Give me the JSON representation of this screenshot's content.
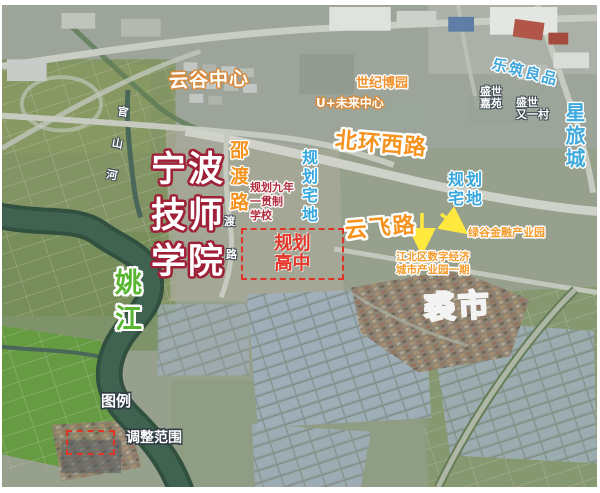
{
  "colors": {
    "road_label_orange": "#f6921e",
    "planning_blue": "#3aa7dd",
    "highlight_red": "#e5372b",
    "college_outline_red": "#9e2138",
    "river_label_green": "#59b630",
    "arrow_yellow": "#ffe93e"
  },
  "labels": {
    "yungu_center": "云谷中心",
    "shiji_boyuan": "世纪博园",
    "u_future_center": "U+未来中心",
    "lezhu_liangpin": "乐筑良品",
    "shengshi_jiayuan_line1": "盛世",
    "shengshi_jiayuan_line2": "嘉苑",
    "shengshi_youyicun_line1": "盛世",
    "shengshi_youyicun_line2": "又一村",
    "xinglvcheng": "星旅城",
    "beihuan_xilu": "北环西路",
    "shaodu_lu": "邵渡路",
    "planned_school_line1": "规划九年",
    "planned_school_line2": "一贯制",
    "planned_school_line3": "学校",
    "planned_plot_left": "规划宅地",
    "college_line1": "宁波",
    "college_line2": "技师",
    "college_line3": "学院",
    "guanshan_river": "官山河",
    "road_char_du": "渡",
    "road_char_lu": "路",
    "planned_plot_right_line1": "规划",
    "planned_plot_right_line2": "宅地",
    "yunfei_lu": "云飞路",
    "lvgu_finance_park": "绿谷金融产业园",
    "jiangbei_park_line1": "江北区数字经济",
    "jiangbei_park_line2": "城市产业园一期",
    "planned_highschool_line1": "规划",
    "planned_highschool_line2": "高中",
    "yaojiang": "姚江",
    "qiushi": "裘市",
    "legend_title": "图例",
    "legend_item_adjust_range": "调整范围"
  }
}
